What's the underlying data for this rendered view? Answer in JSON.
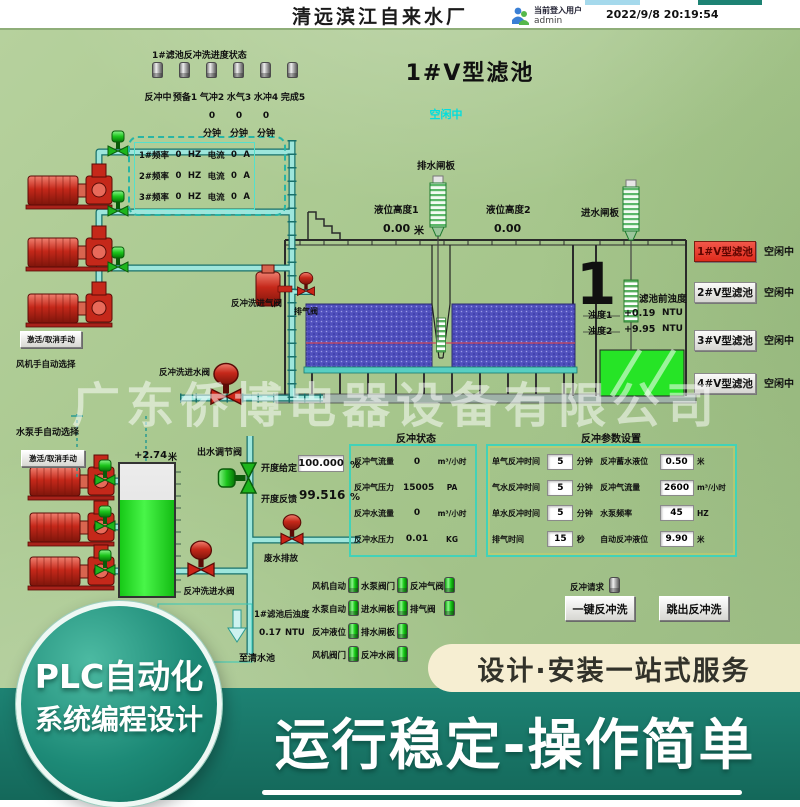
{
  "colors": {
    "bg_green": "#a8c791",
    "banner_teal": "#1d8273",
    "pill_cream": "#f6eed2",
    "active_red": "#df2b1c",
    "pipe_cyan": "#9de6dc",
    "media_blue": "#5050bd",
    "light_green": "#25d825",
    "status_cyan": "#00dede",
    "pump_red": "#c5281a"
  },
  "header": {
    "title": "清远滨江自来水厂",
    "login_label": "当前登入用户",
    "login_user": "admin",
    "datetime": "2022/9/8 20:19:54"
  },
  "progress": {
    "title": "1#滤池反冲洗进度状态",
    "steps": [
      "反冲中",
      "预备1",
      "气冲2",
      "水气3",
      "水冲4",
      "完成5"
    ],
    "timer_values": [
      "0",
      "0",
      "0"
    ],
    "timer_unit": "分钟"
  },
  "pool_title": "1#V型滤池",
  "pool_status": "空闲中",
  "blowers": {
    "rows": [
      {
        "f_label": "1#频率",
        "f_value": "0",
        "f_unit": "HZ",
        "c_label": "电流",
        "c_value": "0",
        "c_unit": "A"
      },
      {
        "f_label": "2#频率",
        "f_value": "0",
        "f_unit": "HZ",
        "c_label": "电流",
        "c_value": "0",
        "c_unit": "A"
      },
      {
        "f_label": "3#频率",
        "f_value": "0",
        "f_unit": "HZ",
        "c_label": "电流",
        "c_value": "0",
        "c_unit": "A"
      }
    ],
    "manual_button": "激活/取消手动",
    "select_label": "风机手自动选择"
  },
  "pool": {
    "drain_gate": "排水闸板",
    "inlet_gate": "进水闸板",
    "level1_label": "液位高度1",
    "level1_value": "0.00",
    "level1_unit": "米",
    "level2_label": "液位高度2",
    "level2_value": "0.00",
    "big_number": "1",
    "pre_turbidity": "滤池前浊度",
    "turbidity": [
      {
        "label": "浊度1",
        "value": "+0.19",
        "unit": "NTU"
      },
      {
        "label": "浊度2",
        "value": "+9.95",
        "unit": "NTU"
      }
    ],
    "air_inlet_valve": "反冲洗进气阀",
    "exhaust_valve": "排气阀",
    "water_inlet_valve": "反冲洗进水阀"
  },
  "filters": [
    {
      "label": "1#V型滤池",
      "status": "空闲中"
    },
    {
      "label": "2#V型滤池",
      "status": "空闲中"
    },
    {
      "label": "3#V型滤池",
      "status": "空闲中"
    },
    {
      "label": "4#V型滤池",
      "status": "空闲中"
    }
  ],
  "backwash_status": {
    "title": "反冲状态",
    "rows": [
      {
        "label": "反冲气流量",
        "value": "0",
        "unit": "m³/小时"
      },
      {
        "label": "反冲气压力",
        "value": "15005",
        "unit": "PA"
      },
      {
        "label": "反冲水流量",
        "value": "0",
        "unit": "m³/小时"
      },
      {
        "label": "反冲水压力",
        "value": "0.01",
        "unit": "KG"
      }
    ]
  },
  "backwash_params": {
    "title": "反冲参数设置",
    "rows": [
      {
        "l_label": "单气反冲时间",
        "l_value": "5",
        "l_unit": "分钟",
        "r_label": "反冲蓄水液位",
        "r_value": "0.50",
        "r_unit": "米"
      },
      {
        "l_label": "气水反冲时间",
        "l_value": "5",
        "l_unit": "分钟",
        "r_label": "反冲气流量",
        "r_value": "2600",
        "r_unit": "m³/小时"
      },
      {
        "l_label": "单水反冲时间",
        "l_value": "5",
        "l_unit": "分钟",
        "r_label": "水泵频率",
        "r_value": "45",
        "r_unit": "HZ"
      },
      {
        "l_label": "排气时间",
        "l_value": "15",
        "l_unit": "秒",
        "r_label": "自动反冲液位",
        "r_value": "9.90",
        "r_unit": "米"
      }
    ]
  },
  "pump_station": {
    "select_label": "水泵手自动选择",
    "manual_button": "激活/取消手动",
    "tank_level": "+2.74",
    "tank_level_unit": "米",
    "outlet_valve": "出水调节阀",
    "opening_set_label": "开度给定",
    "opening_set_value": "100.000",
    "opening_set_unit": "%",
    "opening_fb_label": "开度反馈",
    "opening_fb_value": "99.516",
    "opening_fb_unit": "%",
    "backwash_water_valve": "反冲洗进水阀",
    "waste_valve": "废水排放",
    "post_turbidity_label": "1#滤池后浊度",
    "post_turbidity_value": "0.17",
    "post_turbidity_unit": "NTU",
    "to_clear_pool": "至清水池"
  },
  "interlocks": {
    "col1": [
      "风机自动",
      "水泵自动",
      "反冲液位",
      "风机阀门"
    ],
    "col2": [
      "水泵阀门",
      "进水闸板",
      "排水闸板",
      "反冲水阀"
    ],
    "col3": [
      "反冲气阀",
      "排气阀"
    ],
    "request_label": "反冲请求",
    "one_key_button": "一键反冲洗",
    "exit_button": "跳出反冲洗"
  },
  "watermark": "广东侨博电器设备有限公司",
  "overlay": {
    "plc_line1": "PLC自动化",
    "plc_line2": "系统编程设计",
    "service_pill": "设计·安装一站式服务",
    "banner": "运行稳定-操作简单"
  }
}
